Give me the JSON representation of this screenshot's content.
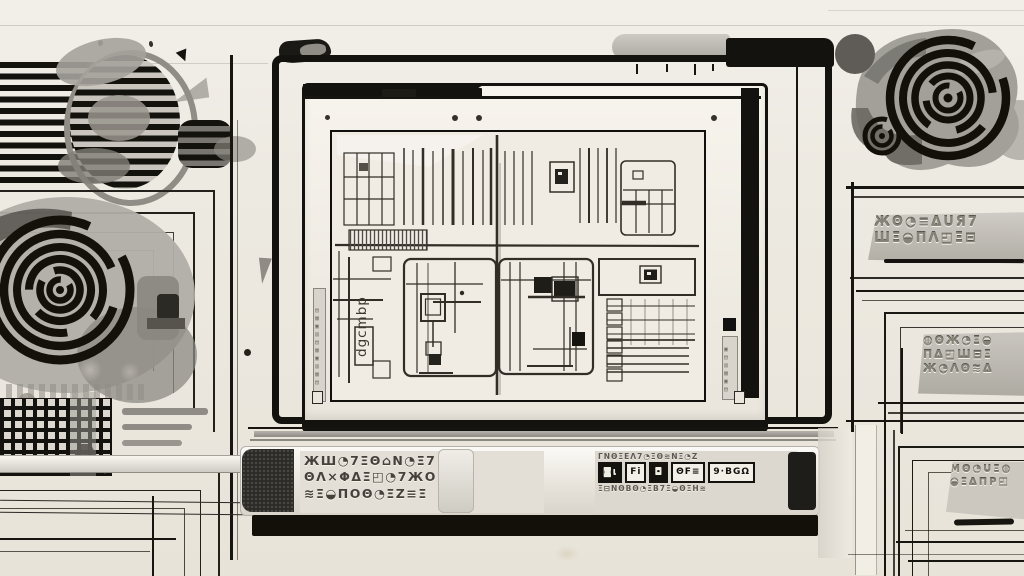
{
  "artwork": {
    "title": "monochrome drafting-workstation illustration",
    "palette": {
      "ink": "#14120e",
      "paper": "#ece8df",
      "paper_light": "#f4f1ea",
      "gray_mid": "#9b9792",
      "gray_dark": "#55524c",
      "gray_light": "#cfccc4"
    }
  },
  "monitor": {
    "left_strip_glyphs": "▤▦▥▣▦▤▥▣▦▤",
    "right_strip_glyphs": "▤▣▦▥▤▣",
    "screen": {
      "vertical_label": "dgcmbp",
      "chip_glyph": "▣",
      "header_chip_glyph": "▣"
    }
  },
  "tray": {
    "left_label_lines": [
      "ЖШ◔7ΞΘ⌂Ν◔Ξ7",
      "ΘΛ×ΦΔΞ◰◔7ЖΟ",
      "≋Ξ◒ΠΟΘ◔ΞΖ≡Ξ"
    ],
    "right_label": {
      "top_line": "ΓΝΘΞΕΛ7◔ΞΘ≋ΝΞ◔Ζ",
      "chips": [
        "◙ι",
        "Fi",
        "◘",
        "ΘF≡",
        "9·BGΩ"
      ],
      "bottom_line": "Ξ⊟ΝΘΒΘ◔ΞΒ7Ξ◒ΘΞΗ≋"
    }
  },
  "plates": {
    "p1": [
      "ЖΘ◔≡ΔUЯ7",
      "ШΞ◒ΠΛ◰Ξ⊟"
    ],
    "p2": [
      "◍ΘЖ◔Ξ◒",
      "ΠΔ◰Ш⊟Ξ",
      "Ж◔ΛΘ≋Δ"
    ],
    "p3": [
      "ΜΘ◔UΞ◍",
      "◒ΞΔΠР◰"
    ]
  },
  "marks": {
    "arrow_glyph": "▼"
  }
}
